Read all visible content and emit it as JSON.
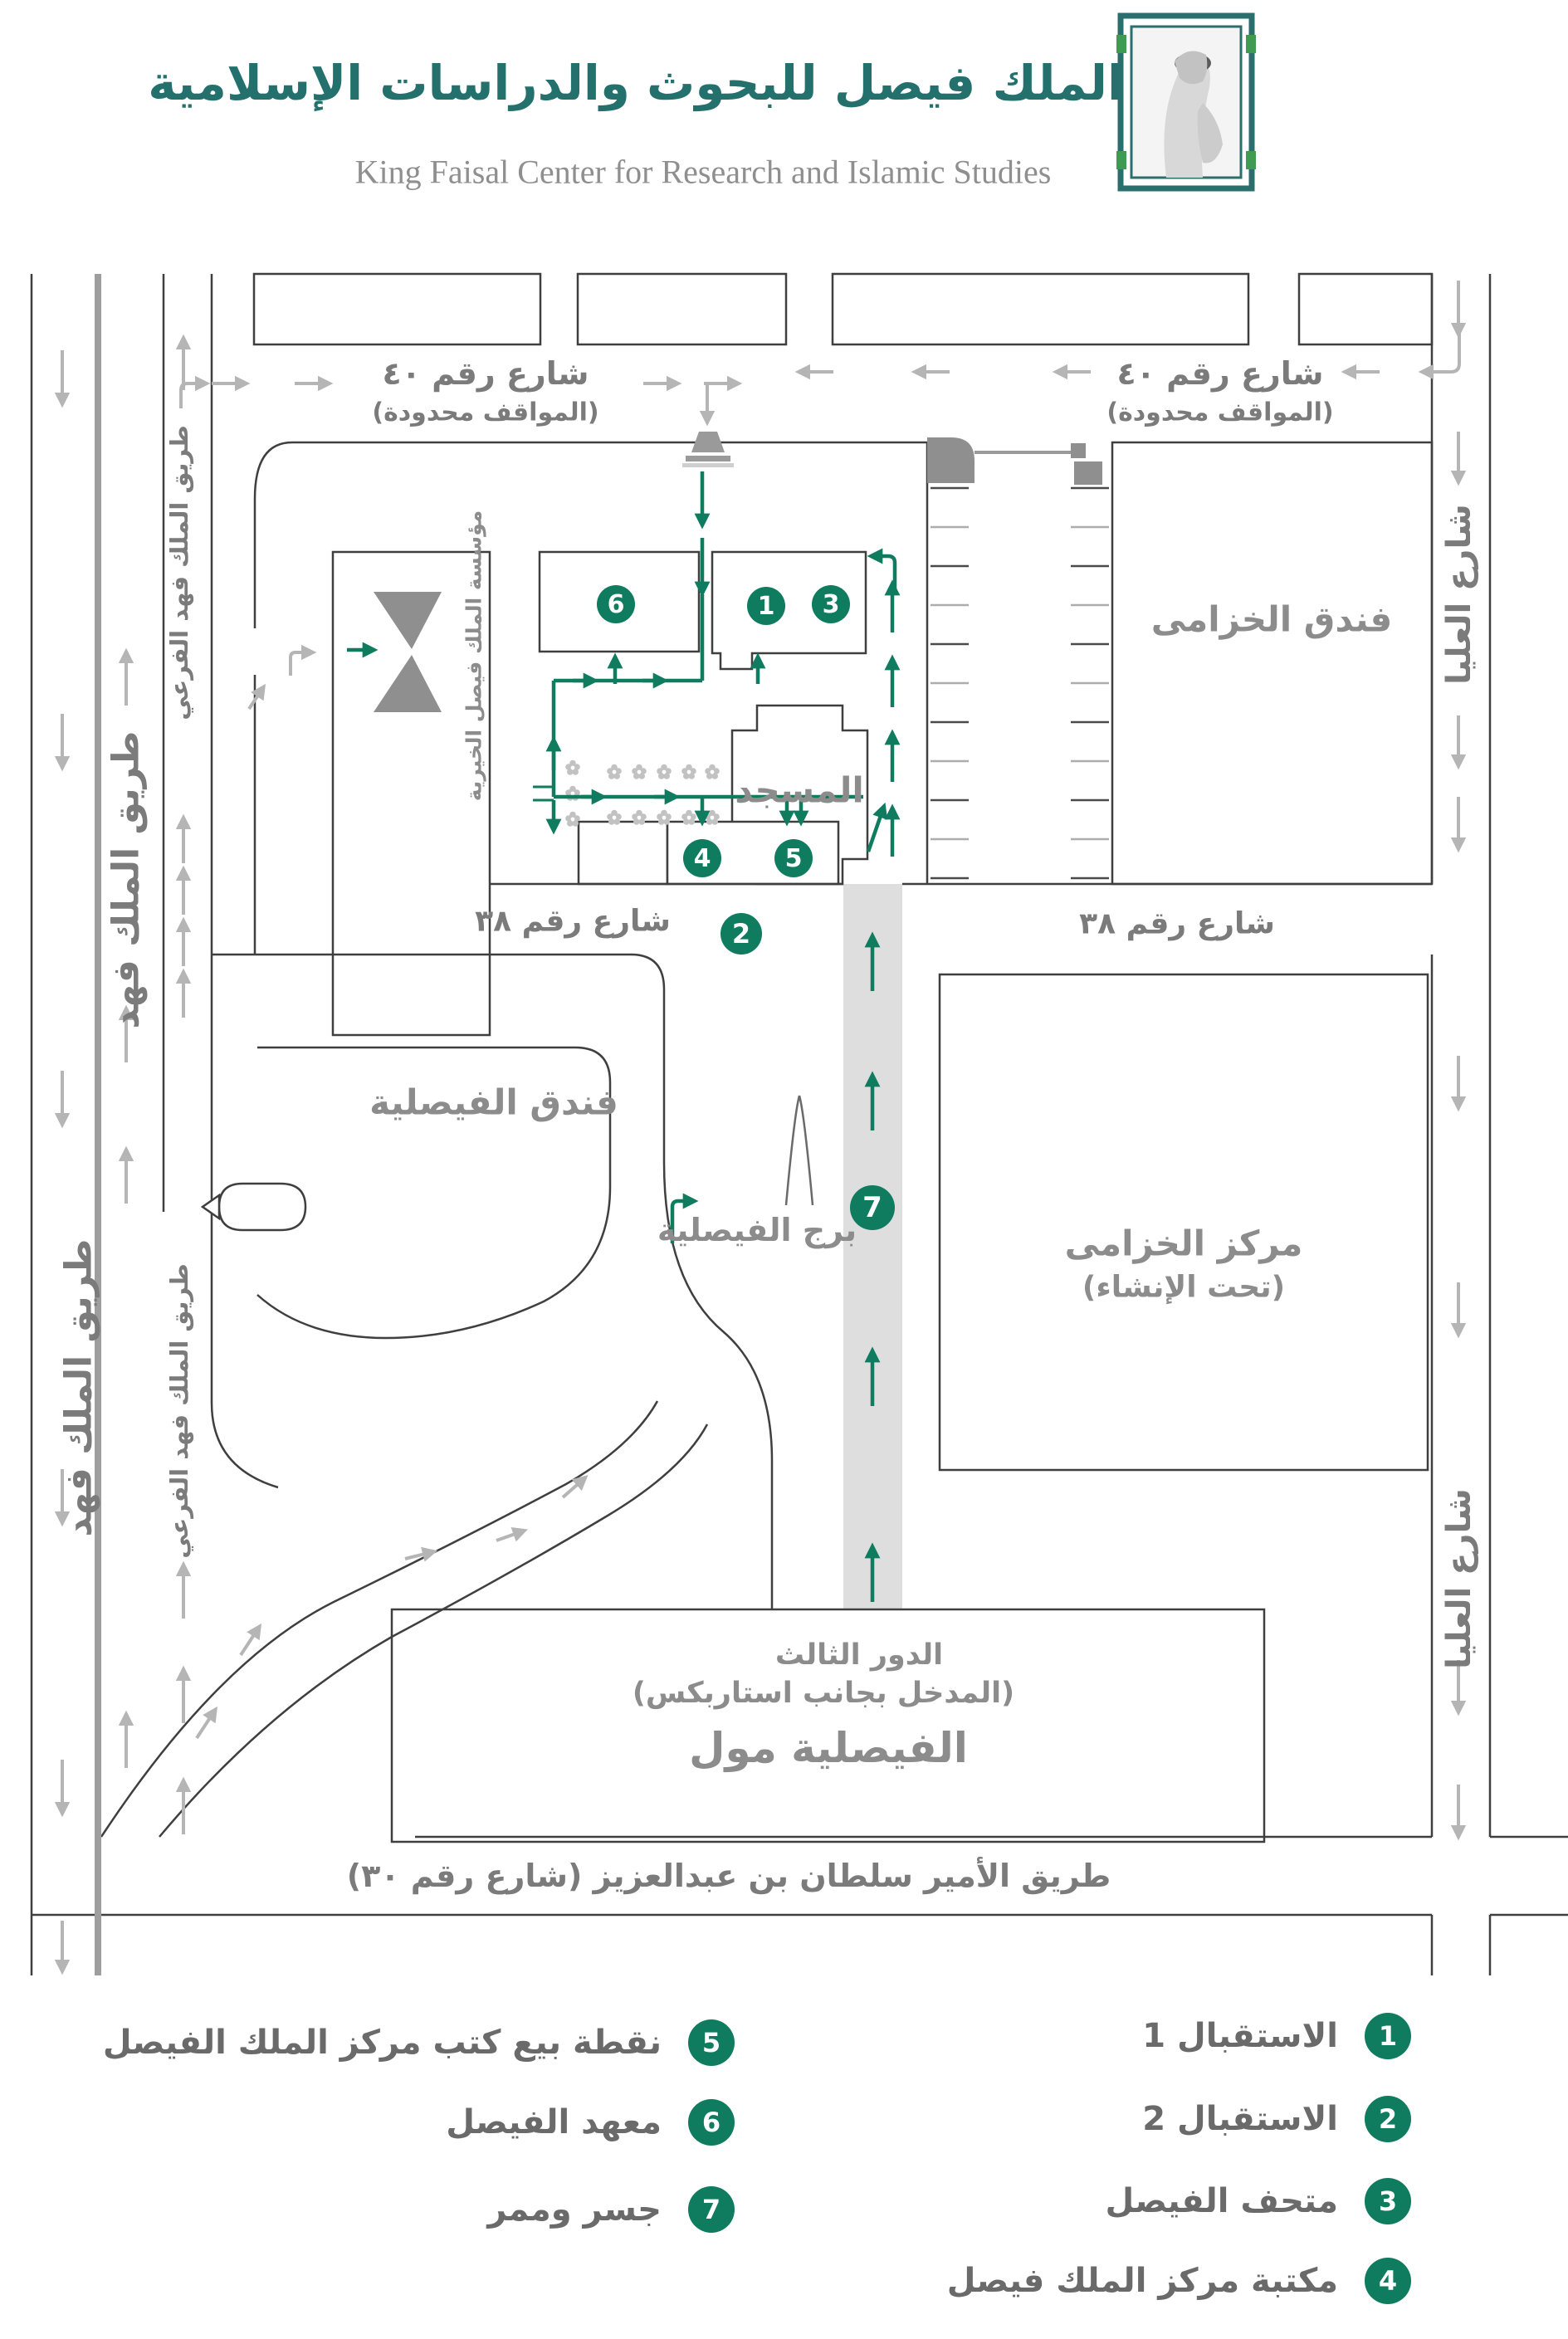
{
  "header": {
    "calligraphy": "مركز الملك فيصل للبحوث والدراسات الإسلامية",
    "english_title": "King Faisal Center for Research and Islamic Studies",
    "logo_icon": "king-faisal-praying-portrait-logo"
  },
  "colors": {
    "accent_green": "#0f7b5f",
    "calligraphy_teal": "#24706d",
    "street_label_gray": "#7b7b7b",
    "building_label_gray": "#8c8c8c",
    "traffic_arrow_gray": "#b5b5b5",
    "road_line_gray": "#3f3f3f",
    "walkway_fill": "#dedede"
  },
  "map": {
    "streets": {
      "street40_left": {
        "name": "شارع رقم ٤٠",
        "note": "(المواقف محدودة)"
      },
      "street40_right": {
        "name": "شارع رقم ٤٠",
        "note": "(المواقف محدودة)"
      },
      "street38_left": "شارع رقم ٣٨",
      "street38_right": "شارع رقم ٣٨",
      "olaya_upper": "شارع العليا",
      "olaya_lower": "شارع العليا",
      "king_fahd_upper": "طريق الملك فهد",
      "king_fahd_lower": "طريق الملك فهد",
      "king_fahd_service_upper": "طريق الملك فهد الفرعي",
      "king_fahd_service_lower": "طريق الملك فهد الفرعي",
      "prince_sultan": "طريق الأمير سلطان بن عبدالعزيز (شارع رقم ٣٠)"
    },
    "places": {
      "khozama_hotel": "فندق الخزامى",
      "khozama_center_line1": "مركز الخزامى",
      "khozama_center_line2": "(تحت الإنشاء)",
      "mosque": "المسجد",
      "foundation": "مؤسسة الملك فيصل الخيرية",
      "faisaliah_hotel": "فندق الفيصلية",
      "faisaliah_tower": "برج الفيصلية",
      "faisaliah_mall": "الفيصلية مول",
      "third_floor_line1": "الدور الثالث",
      "third_floor_line2": "(المدخل بجانب استاربكس)"
    },
    "markers": [
      "1",
      "2",
      "3",
      "4",
      "5",
      "6",
      "7"
    ]
  },
  "legend": {
    "right": [
      {
        "num": "1",
        "label": "الاستقبال 1"
      },
      {
        "num": "2",
        "label": "الاستقبال 2"
      },
      {
        "num": "3",
        "label": "متحف الفيصل"
      },
      {
        "num": "4",
        "label": "مكتبة مركز الملك فيصل"
      }
    ],
    "left": [
      {
        "num": "5",
        "label": "نقطة بيع كتب مركز الملك الفيصل"
      },
      {
        "num": "6",
        "label": "معهد الفيصل"
      },
      {
        "num": "7",
        "label": "جسر وممر"
      }
    ]
  }
}
